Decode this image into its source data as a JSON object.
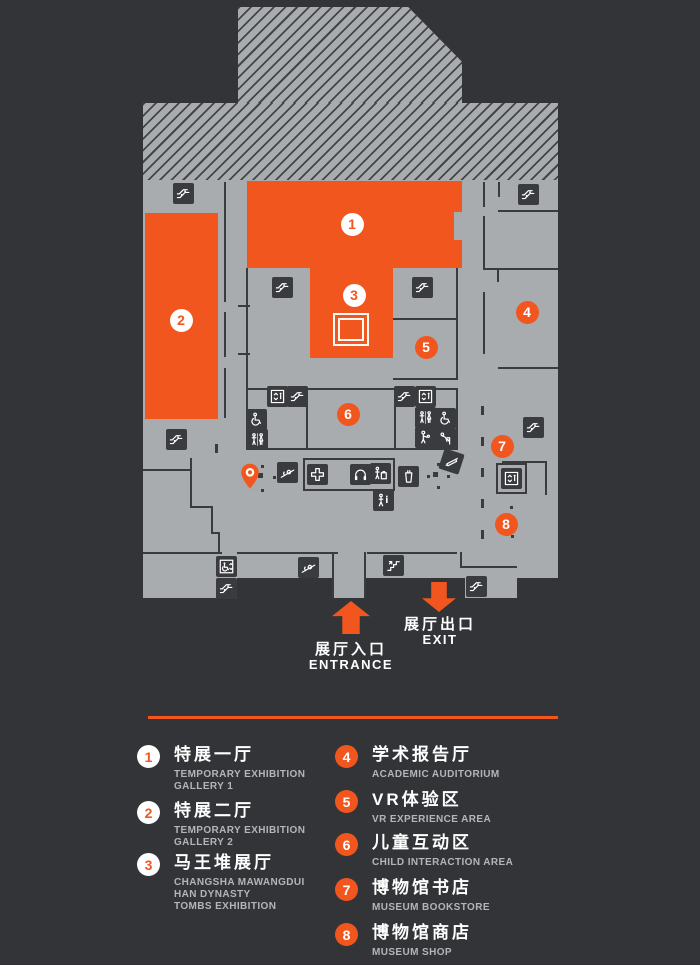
{
  "palette": {
    "background": "#333437",
    "floor": "#a9acae",
    "dark": "#3a3b3e",
    "orange": "#f1561e",
    "white": "#ffffff",
    "subtext": "#b4b5b7"
  },
  "map": {
    "rooms": [
      {
        "id": "room-temporary-exhibition-gallery-1",
        "x": 247,
        "y": 181,
        "w": 215,
        "h": 87
      },
      {
        "id": "room-temporary-exhibition-gallery-2",
        "x": 145,
        "y": 213,
        "w": 73,
        "h": 206
      },
      {
        "id": "room-mawangdui-tombs-exhibition",
        "x": 310,
        "y": 268,
        "w": 83,
        "h": 90
      }
    ],
    "badges": [
      {
        "num": "1",
        "variant": "light",
        "x": 352,
        "y": 224
      },
      {
        "num": "2",
        "variant": "light",
        "x": 181,
        "y": 320
      },
      {
        "num": "3",
        "variant": "light",
        "x": 354,
        "y": 295
      },
      {
        "num": "4",
        "variant": "solid",
        "x": 527,
        "y": 312
      },
      {
        "num": "5",
        "variant": "solid",
        "x": 426,
        "y": 347
      },
      {
        "num": "6",
        "variant": "solid",
        "x": 348,
        "y": 414
      },
      {
        "num": "7",
        "variant": "solid",
        "x": 502,
        "y": 446
      },
      {
        "num": "8",
        "variant": "solid",
        "x": 506,
        "y": 524
      }
    ],
    "icons": [
      {
        "name": "escalator-icon",
        "x": 183,
        "y": 193
      },
      {
        "name": "escalator-icon",
        "x": 528,
        "y": 194
      },
      {
        "name": "escalator-icon",
        "x": 282,
        "y": 287
      },
      {
        "name": "escalator-icon",
        "x": 422,
        "y": 287
      },
      {
        "name": "escalator-icon",
        "x": 176,
        "y": 439
      },
      {
        "name": "elevator-icon",
        "x": 277,
        "y": 396
      },
      {
        "name": "escalator-icon",
        "x": 297,
        "y": 396
      },
      {
        "name": "wheelchair-icon",
        "x": 256,
        "y": 419
      },
      {
        "name": "restroom-icon",
        "x": 257,
        "y": 439
      },
      {
        "name": "escalator-icon",
        "x": 404,
        "y": 396
      },
      {
        "name": "elevator-icon",
        "x": 425,
        "y": 396
      },
      {
        "name": "restroom-icon",
        "x": 425,
        "y": 417
      },
      {
        "name": "wheelchair-icon",
        "x": 445,
        "y": 418
      },
      {
        "name": "baby-care-icon",
        "x": 425,
        "y": 437
      },
      {
        "name": "drinking-fountain-icon",
        "x": 445,
        "y": 438
      },
      {
        "name": "first-aid-icon",
        "x": 317,
        "y": 474
      },
      {
        "name": "audio-guide-icon",
        "x": 360,
        "y": 474
      },
      {
        "name": "locker-icon",
        "x": 380,
        "y": 473
      },
      {
        "name": "water-dispenser-icon",
        "x": 408,
        "y": 476
      },
      {
        "name": "information-icon",
        "x": 383,
        "y": 500
      },
      {
        "name": "calligraphy-pen-icon",
        "x": 451,
        "y": 461,
        "rot": 18
      },
      {
        "name": "ramp-icon",
        "x": 287,
        "y": 472
      },
      {
        "name": "ramp-icon",
        "x": 308,
        "y": 567
      },
      {
        "name": "stairs-icon",
        "x": 393,
        "y": 565
      },
      {
        "name": "escalator-icon",
        "x": 533,
        "y": 427
      },
      {
        "name": "elevator-icon",
        "x": 511,
        "y": 478,
        "boxed": true
      },
      {
        "name": "accessible-elevator-icon",
        "x": 226,
        "y": 566
      },
      {
        "name": "escalator-icon",
        "x": 226,
        "y": 588
      },
      {
        "name": "escalator-icon",
        "x": 476,
        "y": 586
      },
      {
        "name": "location-pin-icon",
        "x": 250,
        "y": 476
      }
    ],
    "walls": [
      [
        483,
        182,
        2,
        25
      ],
      [
        483,
        216,
        2,
        52
      ],
      [
        498,
        182,
        2,
        15
      ],
      [
        498,
        210,
        60,
        2
      ],
      [
        483,
        268,
        75,
        2
      ],
      [
        497,
        270,
        2,
        12
      ],
      [
        498,
        367,
        60,
        2
      ],
      [
        483,
        292,
        2,
        62
      ],
      [
        224,
        182,
        2,
        120
      ],
      [
        224,
        312,
        2,
        45
      ],
      [
        224,
        368,
        2,
        50
      ],
      [
        238,
        305,
        12,
        2
      ],
      [
        238,
        353,
        12,
        2
      ],
      [
        190,
        458,
        2,
        50
      ],
      [
        190,
        506,
        23,
        2
      ],
      [
        211,
        506,
        2,
        28
      ],
      [
        211,
        532,
        9,
        2
      ],
      [
        218,
        532,
        2,
        22
      ],
      [
        143,
        469,
        47,
        2
      ],
      [
        143,
        552,
        79,
        2
      ],
      [
        237,
        552,
        101,
        2
      ],
      [
        367,
        552,
        90,
        2
      ],
      [
        460,
        552,
        2,
        16
      ],
      [
        460,
        566,
        57,
        2
      ],
      [
        332,
        552,
        2,
        46
      ],
      [
        364,
        552,
        2,
        46
      ],
      [
        246,
        388,
        212,
        2
      ],
      [
        246,
        448,
        212,
        2
      ],
      [
        246,
        388,
        2,
        62
      ],
      [
        456,
        388,
        2,
        62
      ],
      [
        306,
        388,
        2,
        62
      ],
      [
        394,
        388,
        2,
        62
      ],
      [
        303,
        458,
        92,
        2
      ],
      [
        303,
        489,
        92,
        2
      ],
      [
        303,
        458,
        2,
        33
      ],
      [
        393,
        458,
        2,
        33
      ],
      [
        456,
        268,
        2,
        112
      ],
      [
        393,
        318,
        65,
        2
      ],
      [
        393,
        378,
        65,
        2
      ],
      [
        246,
        268,
        2,
        120
      ],
      [
        502,
        461,
        45,
        2
      ],
      [
        545,
        461,
        2,
        34
      ]
    ],
    "dashes": [
      [
        481,
        406
      ],
      [
        481,
        437
      ],
      [
        481,
        468
      ],
      [
        481,
        499
      ],
      [
        481,
        530
      ],
      [
        215,
        444
      ]
    ],
    "dots": [
      [
        262,
        466,
        3
      ],
      [
        274,
        477,
        3
      ],
      [
        262,
        490,
        3
      ],
      [
        260,
        475,
        5
      ],
      [
        438,
        464,
        3
      ],
      [
        428,
        476,
        3
      ],
      [
        448,
        476,
        3
      ],
      [
        438,
        487,
        3
      ],
      [
        435,
        474,
        5
      ],
      [
        511,
        507,
        3
      ],
      [
        512,
        536,
        3
      ]
    ]
  },
  "entrance": {
    "label_cn": "展厅入口",
    "label_en": "ENTRANCE"
  },
  "exit": {
    "label_cn": "展厅出口",
    "label_en": "EXIT"
  },
  "legend": {
    "items": [
      {
        "num": "1",
        "variant": "light",
        "title": "特展一厅",
        "subtitle": [
          "TEMPORARY EXHIBITION",
          "GALLERY 1"
        ],
        "x": 137,
        "y": 746
      },
      {
        "num": "2",
        "variant": "light",
        "title": "特展二厅",
        "subtitle": [
          "TEMPORARY EXHIBITION",
          "GALLERY 2"
        ],
        "x": 137,
        "y": 802
      },
      {
        "num": "3",
        "variant": "light",
        "title": "马王堆展厅",
        "subtitle": [
          "CHANGSHA MAWANGDUI",
          "HAN DYNASTY",
          "TOMBS EXHIBITION"
        ],
        "x": 137,
        "y": 854
      },
      {
        "num": "4",
        "variant": "solid",
        "title": "学术报告厅",
        "subtitle": [
          "ACADEMIC AUDITORIUM"
        ],
        "x": 335,
        "y": 746
      },
      {
        "num": "5",
        "variant": "solid",
        "title": "VR体验区",
        "subtitle": [
          "VR EXPERIENCE AREA"
        ],
        "x": 335,
        "y": 791
      },
      {
        "num": "6",
        "variant": "solid",
        "title": "儿童互动区",
        "subtitle": [
          "CHILD INTERACTION AREA"
        ],
        "x": 335,
        "y": 834
      },
      {
        "num": "7",
        "variant": "solid",
        "title": "博物馆书店",
        "subtitle": [
          "MUSEUM BOOKSTORE"
        ],
        "x": 335,
        "y": 879
      },
      {
        "num": "8",
        "variant": "solid",
        "title": "博物馆商店",
        "subtitle": [
          "MUSEUM SHOP"
        ],
        "x": 335,
        "y": 924
      }
    ]
  }
}
